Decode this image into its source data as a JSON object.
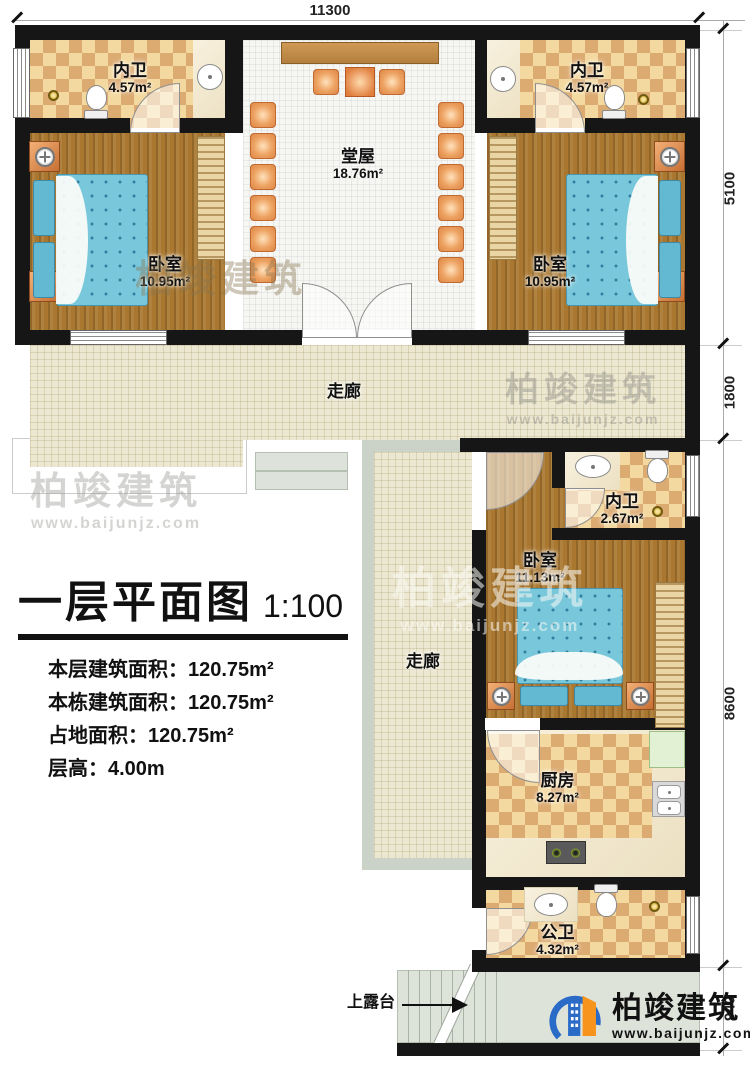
{
  "canvas": {
    "width": 750,
    "height": 1066
  },
  "dimensions": {
    "top": "11300",
    "right": [
      "5100",
      "1800",
      "8600",
      "940"
    ]
  },
  "rooms": {
    "bath_tl": {
      "name": "内卫",
      "area": "4.57m²"
    },
    "bath_tr": {
      "name": "内卫",
      "area": "4.57m²"
    },
    "hall": {
      "name": "堂屋",
      "area": "18.76m²"
    },
    "bed_tl": {
      "name": "卧室",
      "area": "10.95m²"
    },
    "bed_tr": {
      "name": "卧室",
      "area": "10.95m²"
    },
    "corridor_h": {
      "name": "走廊"
    },
    "corridor_v": {
      "name": "走廊"
    },
    "bath_mid": {
      "name": "内卫",
      "area": "2.67m²"
    },
    "bed_mid": {
      "name": "卧室",
      "area": "11.13m²"
    },
    "kitchen": {
      "name": "厨房",
      "area": "8.27m²"
    },
    "bath_public": {
      "name": "公卫",
      "area": "4.32m²"
    },
    "terrace": {
      "name": "上露台"
    }
  },
  "title_block": {
    "title": "一层平面图",
    "scale": "1:100",
    "info_lines": [
      "本层建筑面积：120.75m²",
      "本栋建筑面积：120.75m²",
      "占地面积：120.75m²",
      "层高：4.00m"
    ]
  },
  "branding": {
    "name": "柏竣建筑",
    "url": "www.baijunjz.com"
  },
  "colors": {
    "wall": "#161616",
    "wood_floor": "#a9772f",
    "tile_light": "#f3d99f",
    "tile_dark": "#dcab72",
    "corridor_floor": "#ece7d1",
    "bed_blue": "#79c7db",
    "furniture_orange": "#e08c4e",
    "terrace_gray": "#dde3d9",
    "logo_blue": "#2a6bc8",
    "logo_orange": "#f7941d"
  }
}
